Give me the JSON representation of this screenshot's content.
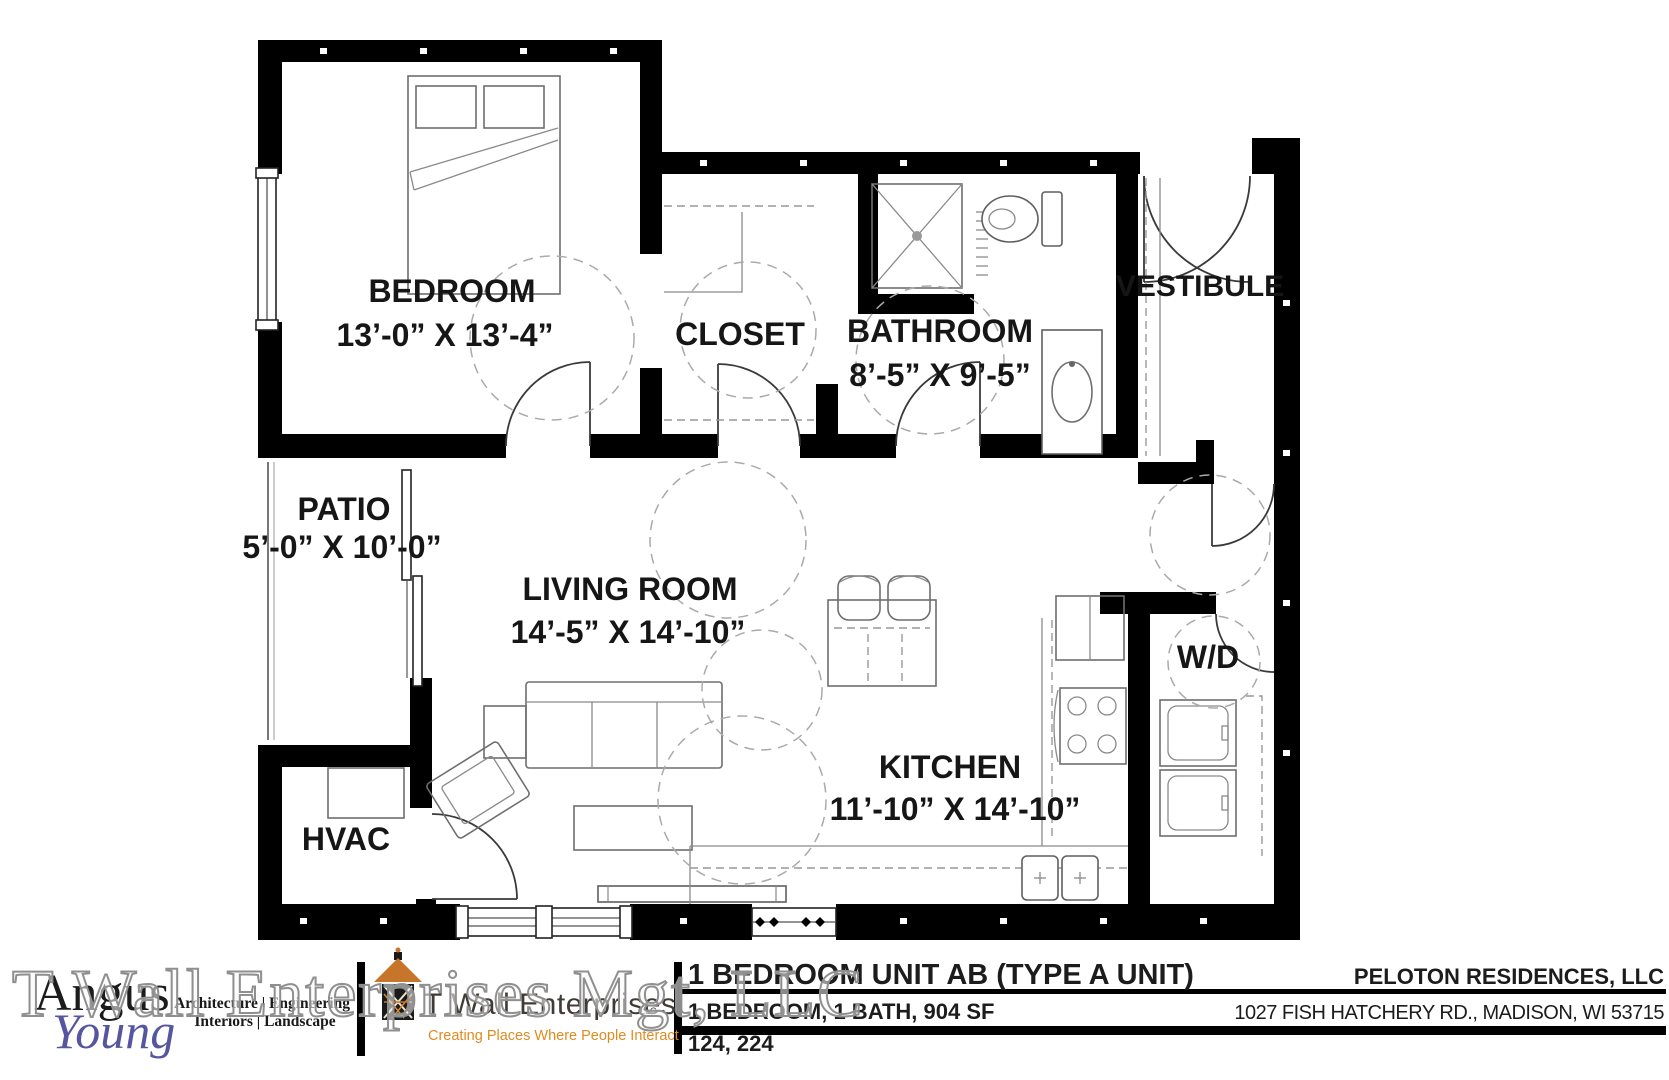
{
  "plan": {
    "rooms": {
      "bedroom": {
        "label": "BEDROOM",
        "dims": "13’-0” X 13’-4”"
      },
      "closet": {
        "label": "CLOSET"
      },
      "bathroom": {
        "label": "BATHROOM",
        "dims": "8’-5” X 9’-5”"
      },
      "vestibule": {
        "label": "VESTIBULE"
      },
      "patio": {
        "label": "PATIO",
        "dims": "5’-0” X 10’-0”"
      },
      "living_room": {
        "label": "LIVING ROOM",
        "dims": "14’-5” X 14’-10”"
      },
      "kitchen": {
        "label": "KITCHEN",
        "dims": "11’-10” X 14’-10”"
      },
      "washer_dryer": {
        "label": "W/D"
      },
      "hvac": {
        "label": "HVAC"
      }
    }
  },
  "title_block": {
    "unit_title": "1 BEDROOM UNIT AB (TYPE A UNIT)",
    "unit_specs": "1 BEDROOM, 1 BATH, 904 SF",
    "unit_numbers": "124, 224",
    "owner": "PELOTON RESIDENCES, LLC",
    "address": "1027 FISH HATCHERY RD., MADISON, WI 53715"
  },
  "branding": {
    "architect": {
      "name_line1": "Angus",
      "name_line2": "Young",
      "services_line1": "Architecture | Engineering",
      "services_line2": "Interiors | Landscape"
    },
    "developer": {
      "name": "T Wall Enterprises",
      "suffix": "LLC",
      "tagline": "Creating Places Where People Interact"
    }
  },
  "watermark": "T Wall Enterprises Mgt, LLC",
  "colors": {
    "wall": "#000000",
    "roof_orange": "#c8752c",
    "tagline_orange": "#e08b21",
    "logo_blue": "#5656a0"
  }
}
